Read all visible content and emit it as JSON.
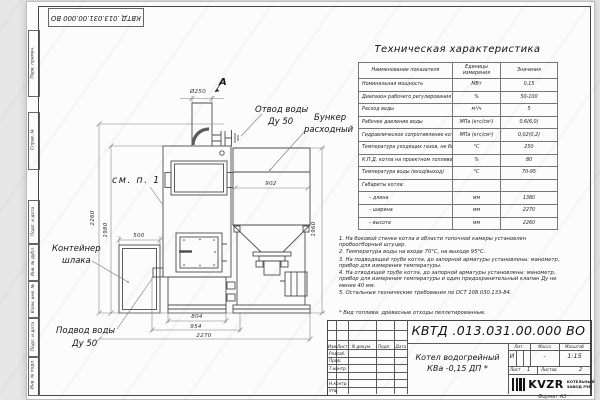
{
  "colors": {
    "background": "#e7e7e7",
    "paper": "#fcfcfc",
    "line": "#4c4c4c"
  },
  "frame": {
    "doc_number_top": "КВТД .013.031.00.000 ВО",
    "format_label": "Формат А3",
    "stamps": {
      "perv_primen": "Перв. примен.",
      "sprav_n": "Справ. №",
      "podp_data_1": "Подп. и дата",
      "inv_dubl": "Инв. № дубл.",
      "vzam_inv": "Взам. инв. №",
      "podp_data_2": "Подп. и дата",
      "inv_podl": "Инв. № подл."
    }
  },
  "tech_table": {
    "title": "Техническая характеристика",
    "col_headers": [
      "Наименование показателя",
      "Единицы измерения",
      "Значения"
    ],
    "rows": [
      {
        "name": "Номинальная мощность",
        "unit": "МВт",
        "value": "0,15"
      },
      {
        "name": "Диапазон рабочего регулирования",
        "unit": "%",
        "value": "50-100"
      },
      {
        "name": "Расход воды",
        "unit": "м³/ч",
        "value": "5"
      },
      {
        "name": "Рабочее давление воды",
        "unit": "МПа (кгс/см²)",
        "value": "0,6(6,0)"
      },
      {
        "name": "Гидравлическое сопротивление котла",
        "unit": "МПа (кгс/см²)",
        "value": "0,02(0,2)"
      },
      {
        "name": "Температура уходящих газов, не более",
        "unit": "°С",
        "value": "250"
      },
      {
        "name": "К.П.Д. котла на проектном топливе",
        "unit": "%",
        "value": "80"
      },
      {
        "name": "Температура воды (вход/выход)",
        "unit": "°С",
        "value": "70-95"
      },
      {
        "name": "Габариты котла:",
        "unit": "",
        "value": ""
      },
      {
        "name": "– длина",
        "unit": "мм",
        "value": "1380"
      },
      {
        "name": "– ширина",
        "unit": "мм",
        "value": "2270"
      },
      {
        "name": "– высота",
        "unit": "мм",
        "value": "2260"
      }
    ]
  },
  "drawing": {
    "view_arrow": "А",
    "labels": {
      "otvod_1": "Отвод воды",
      "otvod_2": "Ду 50",
      "bunker_1": "Бункер",
      "bunker_2": "расходный",
      "sm_p1": "см. п. 1",
      "container_1": "Контейнер",
      "container_2": "шлака",
      "podvod_1": "Подвод воды",
      "podvod_2": "Ду 50"
    },
    "dimensions": {
      "d250": "Ø250",
      "w902": "902",
      "h1960": "1960",
      "h2260": "2260",
      "h1980": "1980",
      "w500": "500",
      "w804": "804",
      "w954": "954",
      "w2270": "2270"
    }
  },
  "notes": {
    "items": [
      "1. На боковой стенке котла в области топочной камеры установлен пробоотборный штуцер.",
      "2. Температура воды на входе 70°С, на выходе 95°С.",
      "3. На подводящей трубе котла, до запорной арматуры установлены: манометр, прибор для измерения температуры.",
      "4. На отводящей трубе котла, до запорной арматуры установлены: манометр, прибор для измерения температуры и один предохранительный клапан Ду не менее 40 мм.",
      "5. Остальные технические требования по ОСТ 108.030.133-84."
    ],
    "fuel_note": "* Вид топлива: древесные отходы пеллетированные."
  },
  "title_block": {
    "doc_number": "КВТД .013.031.00.000 ВО",
    "product_name_1": "Котел водогрейный",
    "product_name_2": "КВа -0,15  ДП *",
    "header_cols": [
      "Изм.",
      "Лист",
      "N докум.",
      "Подп.",
      "Дата"
    ],
    "row_labels": [
      "Разраб.",
      "Пров.",
      "Т.контр.",
      "Н.контр.",
      "Утв."
    ],
    "lit_label": "Лит.",
    "mass_label": "Масса",
    "scale_label": "Масштаб",
    "lit_value": "И",
    "mass_value": "-",
    "scale_value": "1:15",
    "sheet_label": "Лист",
    "sheet_value": "1",
    "sheets_label": "Листов",
    "sheets_value": "2",
    "logo_text": "KVZR",
    "logo_sub_1": "КОТЕЛЬНЫЙ",
    "logo_sub_2": "ЗАВОД РЭП"
  }
}
